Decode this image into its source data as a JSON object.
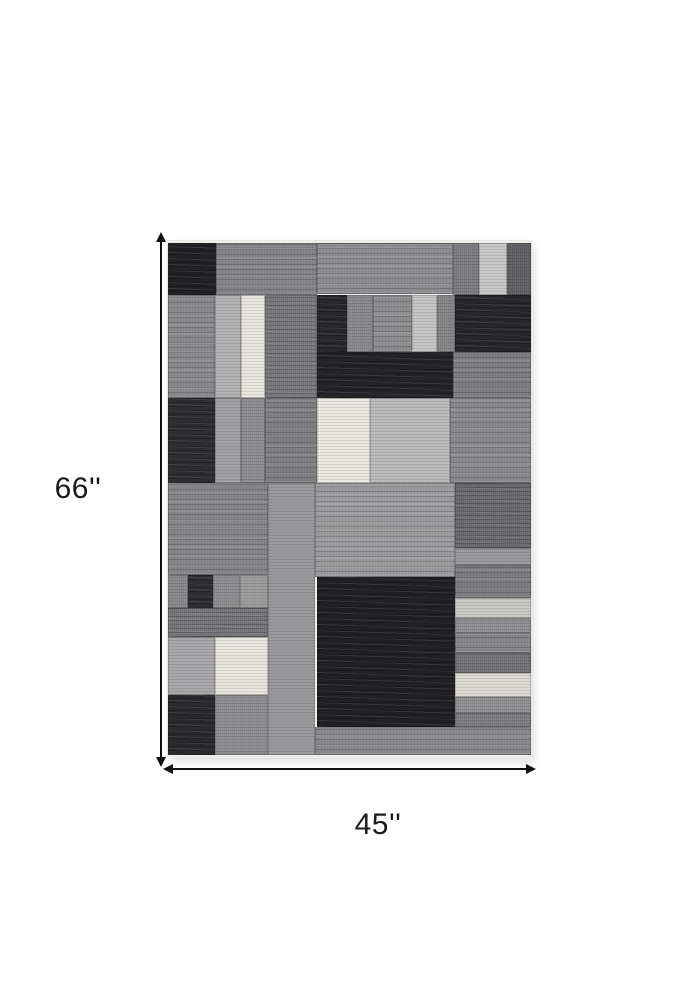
{
  "page": {
    "background": "#ffffff"
  },
  "annotation": {
    "height_label": "66''",
    "width_label": "45''",
    "arrow_color": "#111111"
  },
  "rug": {
    "width_px": 363,
    "height_px": 512,
    "edge_color": "#efefec",
    "blocks": [
      {
        "x": 0,
        "y": 0,
        "w": 48,
        "h": 52,
        "color": "#232327",
        "tex": "heather"
      },
      {
        "x": 48,
        "y": 0,
        "w": 101,
        "h": 52,
        "color": "#85858a",
        "tex": "streak"
      },
      {
        "x": 149,
        "y": 0,
        "w": 136,
        "h": 51,
        "color": "#8f8f93",
        "tex": "streak"
      },
      {
        "x": 285,
        "y": 0,
        "w": 26,
        "h": 52,
        "color": "#7b7b7f",
        "tex": "fine"
      },
      {
        "x": 311,
        "y": 0,
        "w": 28,
        "h": 52,
        "color": "#c7c7c8",
        "tex": "fine"
      },
      {
        "x": 339,
        "y": 0,
        "w": 24,
        "h": 52,
        "color": "#5d5d61",
        "tex": "fine"
      },
      {
        "x": 0,
        "y": 52,
        "w": 47,
        "h": 103,
        "color": "#8b8b8f",
        "tex": "streak"
      },
      {
        "x": 47,
        "y": 52,
        "w": 26,
        "h": 103,
        "color": "#b1b1b3",
        "tex": "fine"
      },
      {
        "x": 73,
        "y": 52,
        "w": 24,
        "h": 103,
        "color": "#e8e6df",
        "tex": "fine"
      },
      {
        "x": 97,
        "y": 52,
        "w": 52,
        "h": 103,
        "color": "#7e7e82",
        "tex": "heather"
      },
      {
        "x": 149,
        "y": 52,
        "w": 30,
        "h": 57,
        "color": "#29292d",
        "tex": "heather"
      },
      {
        "x": 179,
        "y": 52,
        "w": 26,
        "h": 57,
        "color": "#87878b",
        "tex": "fine"
      },
      {
        "x": 205,
        "y": 52,
        "w": 39,
        "h": 57,
        "color": "#8e8e91",
        "tex": "streak"
      },
      {
        "x": 244,
        "y": 52,
        "w": 25,
        "h": 57,
        "color": "#c4c4c5",
        "tex": "fine"
      },
      {
        "x": 269,
        "y": 52,
        "w": 18,
        "h": 57,
        "color": "#838387",
        "tex": "fine"
      },
      {
        "x": 287,
        "y": 52,
        "w": 76,
        "h": 57,
        "color": "#28282c",
        "tex": "heather"
      },
      {
        "x": 149,
        "y": 109,
        "w": 136,
        "h": 46,
        "color": "#252529",
        "tex": "heather"
      },
      {
        "x": 285,
        "y": 109,
        "w": 78,
        "h": 46,
        "color": "#7f7f83",
        "tex": "streak"
      },
      {
        "x": 0,
        "y": 155,
        "w": 47,
        "h": 85,
        "color": "#2e2e33",
        "tex": "heather"
      },
      {
        "x": 47,
        "y": 155,
        "w": 26,
        "h": 85,
        "color": "#9e9ea1",
        "tex": "fine"
      },
      {
        "x": 73,
        "y": 155,
        "w": 24,
        "h": 85,
        "color": "#8b8b8f",
        "tex": "fine"
      },
      {
        "x": 97,
        "y": 155,
        "w": 52,
        "h": 85,
        "color": "#818185",
        "tex": "streak"
      },
      {
        "x": 149,
        "y": 155,
        "w": 53,
        "h": 85,
        "color": "#eae8e1",
        "tex": "fine"
      },
      {
        "x": 202,
        "y": 155,
        "w": 80,
        "h": 85,
        "color": "#b9b9ba",
        "tex": "fine"
      },
      {
        "x": 282,
        "y": 155,
        "w": 81,
        "h": 85,
        "color": "#8b8b8f",
        "tex": "streak"
      },
      {
        "x": 0,
        "y": 240,
        "w": 100,
        "h": 92,
        "color": "#87878b",
        "tex": "streak"
      },
      {
        "x": 100,
        "y": 240,
        "w": 47,
        "h": 272,
        "color": "#98989b",
        "tex": "fine"
      },
      {
        "x": 147,
        "y": 240,
        "w": 140,
        "h": 94,
        "color": "#9c9c9f",
        "tex": "streak"
      },
      {
        "x": 287,
        "y": 240,
        "w": 76,
        "h": 65,
        "color": "#6e6e73",
        "tex": "heather"
      },
      {
        "x": 287,
        "y": 305,
        "w": 76,
        "h": 17,
        "color": "#97979b",
        "tex": "fine"
      },
      {
        "x": 287,
        "y": 322,
        "w": 76,
        "h": 33,
        "color": "#7e7e82",
        "tex": "streak"
      },
      {
        "x": 287,
        "y": 355,
        "w": 76,
        "h": 20,
        "color": "#c8c8c5",
        "tex": "fine"
      },
      {
        "x": 287,
        "y": 375,
        "w": 76,
        "h": 15,
        "color": "#8c8c90",
        "tex": "fine"
      },
      {
        "x": 287,
        "y": 390,
        "w": 76,
        "h": 20,
        "color": "#86868b",
        "tex": "streak"
      },
      {
        "x": 287,
        "y": 410,
        "w": 76,
        "h": 20,
        "color": "#6f6f74",
        "tex": "fine"
      },
      {
        "x": 287,
        "y": 430,
        "w": 76,
        "h": 24,
        "color": "#dcdad2",
        "tex": "fine"
      },
      {
        "x": 287,
        "y": 454,
        "w": 76,
        "h": 16,
        "color": "#8f8f92",
        "tex": "fine"
      },
      {
        "x": 287,
        "y": 470,
        "w": 76,
        "h": 14,
        "color": "#7a7a7e",
        "tex": "fine"
      },
      {
        "x": 149,
        "y": 334,
        "w": 138,
        "h": 150,
        "color": "#222226",
        "tex": "heather"
      },
      {
        "x": 0,
        "y": 332,
        "w": 20,
        "h": 33,
        "color": "#85858a",
        "tex": "fine"
      },
      {
        "x": 20,
        "y": 332,
        "w": 25,
        "h": 33,
        "color": "#2f2f33",
        "tex": "heather"
      },
      {
        "x": 45,
        "y": 332,
        "w": 27,
        "h": 33,
        "color": "#8b8b8e",
        "tex": "fine"
      },
      {
        "x": 72,
        "y": 332,
        "w": 28,
        "h": 33,
        "color": "#9a9a9c",
        "tex": "fine"
      },
      {
        "x": 0,
        "y": 365,
        "w": 100,
        "h": 29,
        "color": "#7b7b80",
        "tex": "heather"
      },
      {
        "x": 0,
        "y": 394,
        "w": 47,
        "h": 58,
        "color": "#a6a6a8",
        "tex": "fine"
      },
      {
        "x": 47,
        "y": 394,
        "w": 53,
        "h": 58,
        "color": "#e7e5dd",
        "tex": "fine"
      },
      {
        "x": 0,
        "y": 452,
        "w": 47,
        "h": 60,
        "color": "#2a2a2e",
        "tex": "heather"
      },
      {
        "x": 47,
        "y": 452,
        "w": 53,
        "h": 60,
        "color": "#8b8b8e",
        "tex": "fine"
      },
      {
        "x": 147,
        "y": 484,
        "w": 216,
        "h": 28,
        "color": "#8b8b8e",
        "tex": "streak"
      }
    ]
  }
}
